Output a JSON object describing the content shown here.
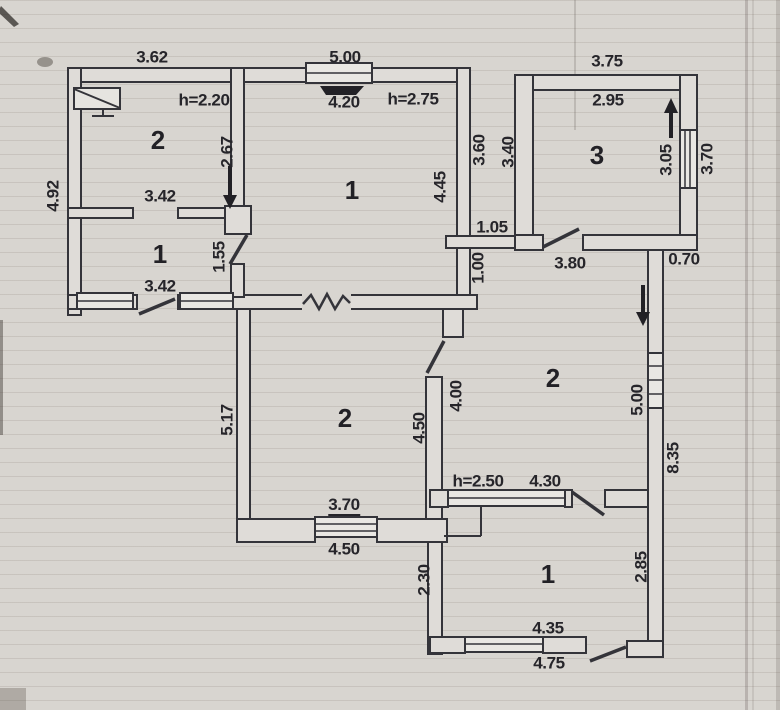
{
  "colors": {
    "paper": "#d8d5d0",
    "ink": "#34343a",
    "wall_fill": "#dfdcd8",
    "window_fill": "#e9e7e3",
    "ruled_line": "#7d736966"
  },
  "plan": {
    "rooms": {
      "left_top": "2",
      "left_hall": "1",
      "left_main": "1",
      "left_center": "2",
      "right_top": "3",
      "right_middle": "2",
      "right_bottom": "1"
    },
    "dims": {
      "outer_width_left": "3.62",
      "outer_width_main": "5.00",
      "room2tl_height_note": "h=2.20",
      "room1_inner_width": "4.20",
      "room1_height_note": "h=2.75",
      "room2tl_east": "2.67",
      "outer_left": "4.92",
      "room2tl_width": "3.42",
      "hall_door": "1.55",
      "hall_width": "3.42",
      "room1_east_outer": "3.60",
      "room1_inner_east": "4.45",
      "passage_gap": "1.05",
      "passage_wall": "1.00",
      "corridor_width": "3.80",
      "right_outer_top": "3.75",
      "room3_inner_width": "2.95",
      "room3_west": "3.40",
      "room3_inner_east": "3.05",
      "room3_east_outer": "3.70",
      "step_offset": "0.70",
      "room2c_west": "5.17",
      "room2c_east_inner": "4.50",
      "room2r_west": "4.00",
      "room2r_east_inner": "5.00",
      "right_outer_east": "8.35",
      "room2c_window": "3.70",
      "room2c_bottom_outer": "4.50",
      "room1b_height_note": "h=2.50",
      "room1b_north": "4.30",
      "room1b_west": "2.30",
      "room1b_east_inner": "2.85",
      "room1b_window": "4.35",
      "room1b_bottom_outer": "4.75"
    }
  }
}
